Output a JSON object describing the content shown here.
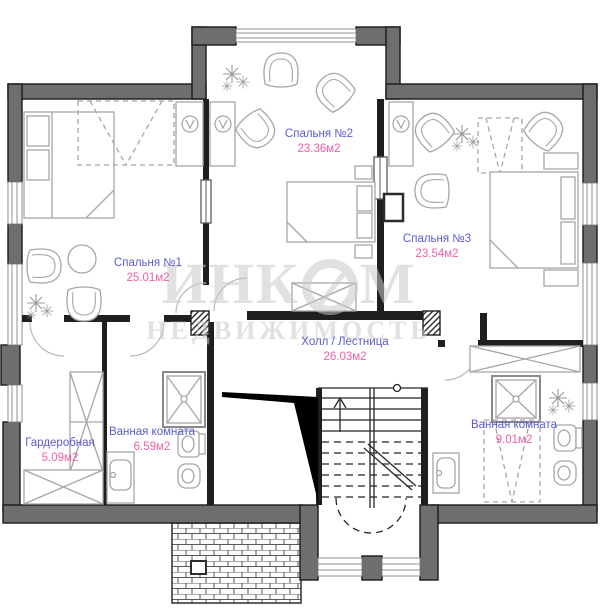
{
  "plan": {
    "rooms": [
      {
        "id": "bedroom-1",
        "name": "Спальня №1",
        "area": "25.01м2"
      },
      {
        "id": "bedroom-2",
        "name": "Спальня №2",
        "area": "23.36м2"
      },
      {
        "id": "bedroom-3",
        "name": "Спальня №3",
        "area": "23.54м2"
      },
      {
        "id": "hall-stairs",
        "name": "Холл / Лестница",
        "area": "26.03м2"
      },
      {
        "id": "wardrobe",
        "name": "Гардеробная",
        "area": "5.09м2"
      },
      {
        "id": "bathroom-1",
        "name": "Ванная комната",
        "area": "6.59м2"
      },
      {
        "id": "bathroom-2",
        "name": "Ванная комната",
        "area": "9.01м2"
      }
    ],
    "watermark": {
      "brand": "ИНКОМ",
      "brand_part1": "ИНК",
      "brand_part2": "М",
      "subtitle": "НЕДВИЖИМОСТЬ"
    },
    "colors": {
      "wall": "#6e6e6e",
      "outline": "#1a1a1a",
      "dark": "#1f1f1f",
      "furniture": "#a6a6a6",
      "room_name": "#5b5bd0",
      "room_area": "#ee5fa7",
      "watermark": "#c9c9c9"
    }
  }
}
